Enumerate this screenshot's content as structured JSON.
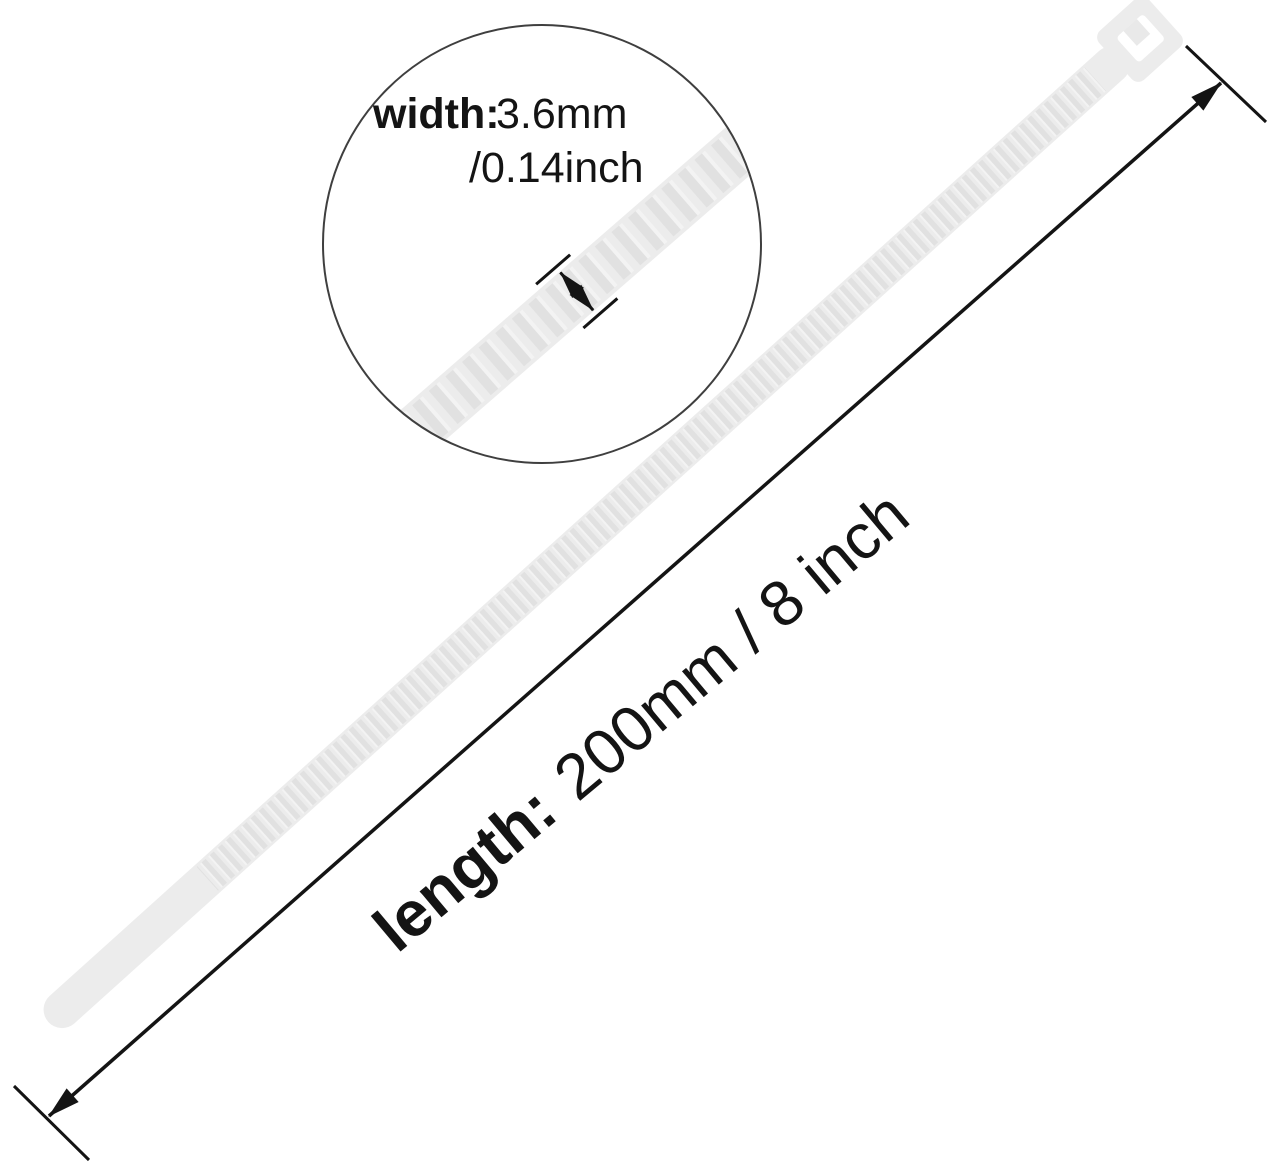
{
  "figure": {
    "kind": "product-dimension-diagram",
    "product": "nylon-cable-tie"
  },
  "magnifier_callout": {
    "width_label": "width:",
    "width_mm": "3.6mm",
    "width_inch": "/0.14inch"
  },
  "length_dimension": {
    "label": "length:",
    "value": "200mm / 8 inch"
  },
  "colors": {
    "background": "#ffffff",
    "tie_body": "#ececec",
    "tie_rib": "#e1e1e1",
    "tie_slot": "#ffffff",
    "annotation_line": "#141414",
    "circle_outline": "#3f3f3f",
    "text": "#141414"
  }
}
